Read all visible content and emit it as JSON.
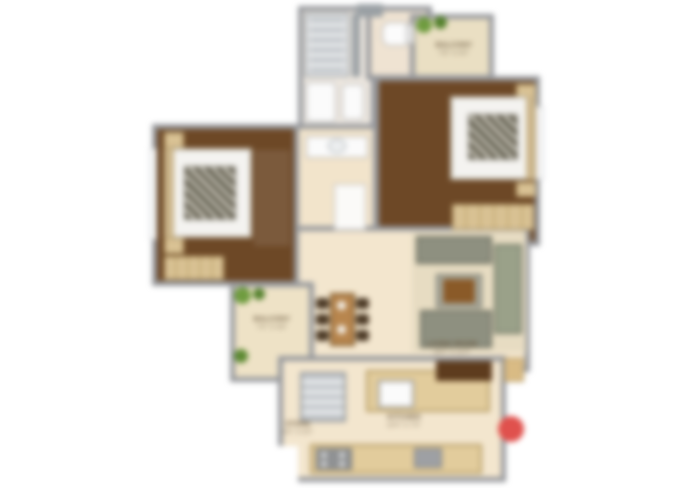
{
  "plan": {
    "kind": "apartment floor plan (blurred screenshot)",
    "colors": {
      "wall": "#96989c",
      "bedroom_floor": "#6d4826",
      "living_floor": "#f3e6ce",
      "balcony_floor": "#eadfc3",
      "bath_floor": "#eee8e0",
      "counter_wood": "#e2cc9c",
      "furniture_wood": "#d9c294",
      "sofa": "#8e9080",
      "plant_green": "#6f9c3f",
      "logo_red": "#e0514d"
    },
    "rooms": [
      {
        "id": "bedroom-1",
        "contents": [
          "double bed",
          "side tables",
          "wardrobe",
          "window"
        ]
      },
      {
        "id": "bedroom-2",
        "contents": [
          "double bed",
          "side tables",
          "wardrobe",
          "window"
        ]
      },
      {
        "id": "bathroom",
        "contents": [
          "shower",
          "wc",
          "basin"
        ]
      },
      {
        "id": "toilet",
        "contents": [
          "wc"
        ]
      },
      {
        "id": "wash-passage",
        "contents": [
          "wash counter",
          "door"
        ]
      },
      {
        "id": "living-dining",
        "contents": [
          "dining table with 6 chairs",
          "sofa set",
          "coffee table",
          "rug"
        ]
      },
      {
        "id": "balcony-top",
        "contents": [
          "plants"
        ]
      },
      {
        "id": "balcony-left",
        "contents": [
          "plants"
        ]
      },
      {
        "id": "kitchen",
        "contents": [
          "shelf rack",
          "sink counter",
          "stove counter",
          "overhead cabinet"
        ]
      }
    ]
  },
  "labels": {
    "balcony_top": {
      "name": "BALCONY",
      "dims": "7'6\" X 4'0\""
    },
    "balcony_left": {
      "name": "BALCONY",
      "dims": "7'0\" X 4'6\""
    },
    "living": {
      "name": "LIVING ROOM",
      "dims": "16'0\" X 11'0\""
    },
    "kitchen": {
      "name": "KITCHEN",
      "dims": "10'0\" X 7'0\""
    },
    "store": {
      "name": "STORE",
      "dims": "4'0\" X 5'0\""
    }
  }
}
